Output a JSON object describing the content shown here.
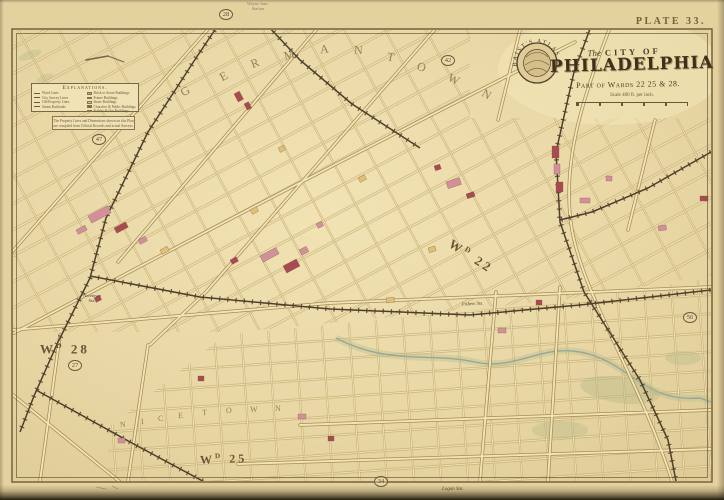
{
  "plate": {
    "label": "PLATE 33."
  },
  "title_block": {
    "seal_text": "BAIST'S ATLAS",
    "prefix": "The",
    "city_of": "CITY OF",
    "city": "PHILADELPHIA",
    "wards_line": "Part of Wards 22 25 & 28.",
    "scale_text": "Scale 400 ft. per inch."
  },
  "legend": {
    "title": "Explanations.",
    "left_items": [
      {
        "label": "Ward Lines"
      },
      {
        "label": "City Survey Lines"
      },
      {
        "label": "Old Property Lines"
      },
      {
        "label": "Steam Railroads"
      }
    ],
    "right_items": [
      {
        "label": "Brick or Stone Buildings",
        "color": "#d4909a"
      },
      {
        "label": "Frame Buildings",
        "color": "#e0c077"
      },
      {
        "label": "Stone Buildings",
        "color": "#b9c0c6"
      },
      {
        "label": "Churches & Public Buildings",
        "color": "#a94a52"
      },
      {
        "label": "Stables & Out Buildings",
        "color": "#cfc3a0"
      }
    ]
  },
  "note": {
    "line1": "The Property Lines and Dimensions shown on this Plan",
    "line2": "are compiled from Official Records and actual Surveys."
  },
  "wards": {
    "wd22": {
      "prefix": "W",
      "sup": "D",
      "num": "22"
    },
    "wd28": {
      "prefix": "W",
      "sup": "D",
      "num": "28"
    },
    "wd25": {
      "prefix": "W",
      "sup": "D",
      "num": "25"
    }
  },
  "plate_refs": [
    {
      "n": "28"
    },
    {
      "n": "47"
    },
    {
      "n": "42"
    },
    {
      "n": "27"
    },
    {
      "n": "56"
    },
    {
      "n": "34"
    }
  ],
  "place_letters": {
    "germantown": [
      "G",
      "E",
      "R",
      "M",
      "A",
      "N",
      "T",
      "O",
      "W",
      "N"
    ],
    "nicetown": [
      "N",
      "I",
      "C",
      "E",
      "T",
      "O",
      "W",
      "N"
    ]
  },
  "stations": {
    "top": {
      "line1": "Wayne Junc.",
      "line2": "Station"
    },
    "nicetown": {
      "line1": "Nicetown",
      "line2": "Sta."
    },
    "fishers": {
      "label": "Fishers Sta."
    },
    "logan": {
      "label": "Logan Sta."
    }
  },
  "colors": {
    "paper": "#e9d8a6",
    "frame": "#6b5a38",
    "street_casing": "#b09655",
    "street_fill": "#f2e3b6",
    "railroad": "#4e3f2a",
    "building_pink": "#d4909a",
    "building_red": "#a94a52",
    "building_yellow": "#e0c077",
    "water": "#97a699",
    "lettering": "#8d7a55"
  }
}
